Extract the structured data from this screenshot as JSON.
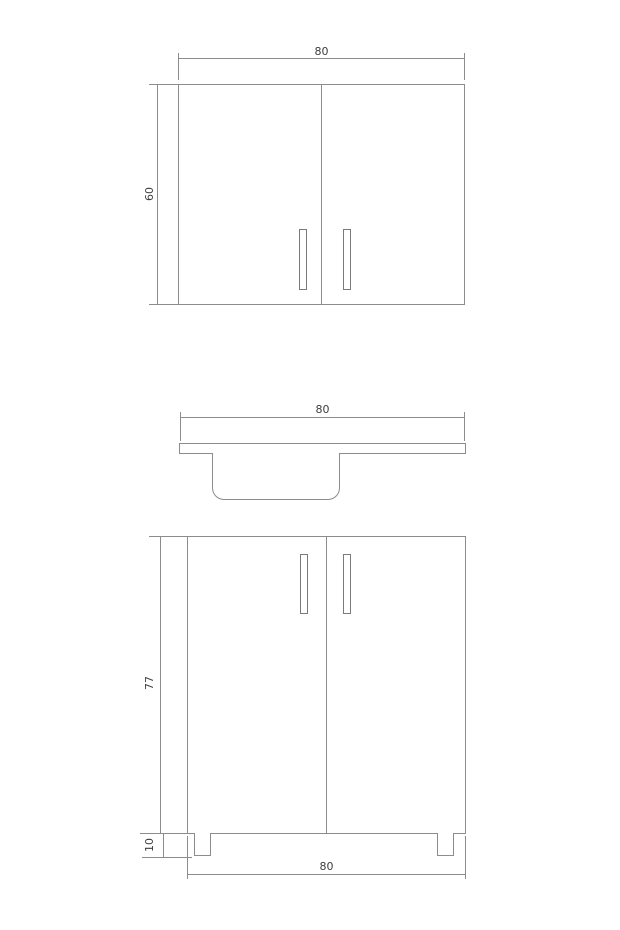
{
  "drawing": {
    "background_color": "#ffffff",
    "line_color": "#8c8c8c",
    "text_color": "#3d3d3d",
    "wall_cabinet": {
      "width_label": "80",
      "height_label": "60"
    },
    "countertop": {
      "width_label": "80"
    },
    "base_cabinet": {
      "height_label": "77",
      "leg_height_label": "10",
      "width_label": "80"
    }
  }
}
